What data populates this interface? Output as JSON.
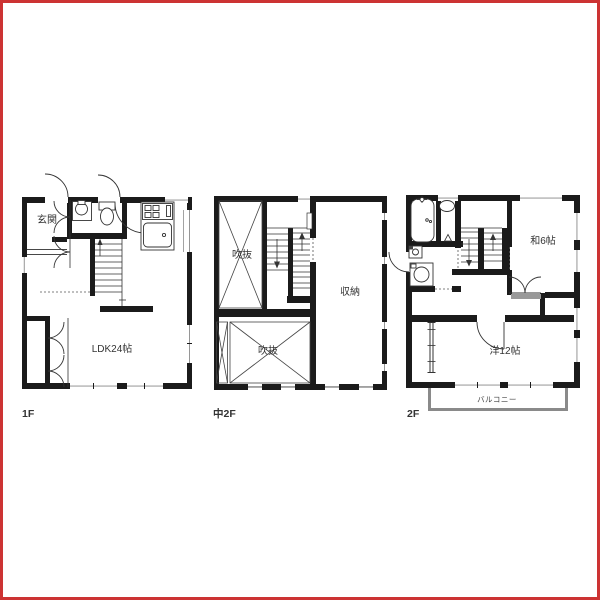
{
  "image": {
    "type": "floor-plan-drawing",
    "background": "#ffffff",
    "frame_color": "#cc3333",
    "wall_color": "#1b1b1b",
    "line_color": "#333333",
    "window_color": "#8a8a8a",
    "balcony_color": "#8a8a8a",
    "text_color": "#333333"
  },
  "floors": [
    {
      "label": "1F",
      "rooms": [
        {
          "label": "玄関"
        },
        {
          "label": "LDK24帖"
        }
      ],
      "fixtures": [
        "entrance-door",
        "entrance-closet-doors",
        "washbasin",
        "toilet",
        "staircase-up",
        "kitchen-stove",
        "kitchen-sink",
        "living-closet-doors"
      ]
    },
    {
      "label": "中2F",
      "rooms": [
        {
          "label": "吹抜"
        },
        {
          "label": "収納"
        },
        {
          "label": "吹抜"
        }
      ],
      "fixtures": [
        "switchback-staircase",
        "void-cross-top",
        "void-cross-bottom"
      ]
    },
    {
      "label": "2F",
      "rooms": [
        {
          "label": "和6帖"
        },
        {
          "label": "洋12帖"
        },
        {
          "label": "バルコニー"
        }
      ],
      "fixtures": [
        "bathtub",
        "washbasin-oval",
        "corner-sink",
        "washing-machine",
        "switchback-staircase",
        "double-closet-doors",
        "room-door",
        "balcony"
      ]
    }
  ]
}
